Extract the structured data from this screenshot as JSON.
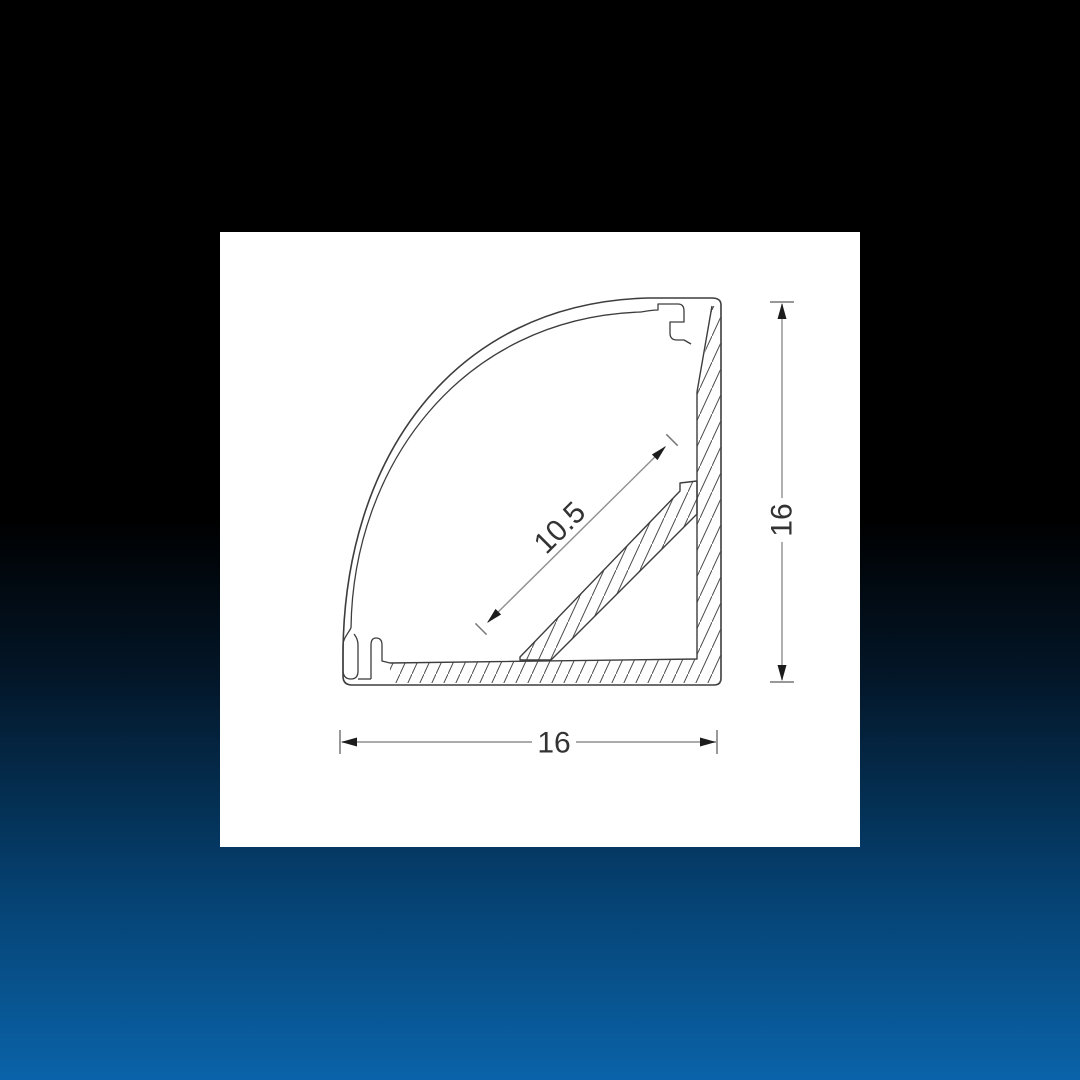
{
  "page": {
    "background_top_color": "#000000",
    "background_bottom_color": "#0a63a9",
    "panel_color": "#ffffff",
    "line_color": "#3d3d3d",
    "dimension_line_color": "#8f8f8f"
  },
  "drawing": {
    "type": "technical-cross-section",
    "subject": "corner LED aluminium profile cross-section with curved diffuser cover",
    "dimensions": [
      {
        "id": "overall-height",
        "value": "16",
        "orientation": "vertical",
        "position": "right"
      },
      {
        "id": "overall-width",
        "value": "16",
        "orientation": "horizontal",
        "position": "bottom"
      },
      {
        "id": "led-mount-surface",
        "value": "10.5",
        "orientation": "diagonal-45deg",
        "position": "inside-cavity"
      }
    ],
    "labels": {
      "height": "16",
      "width": "16",
      "diagonal": "10.5"
    }
  }
}
